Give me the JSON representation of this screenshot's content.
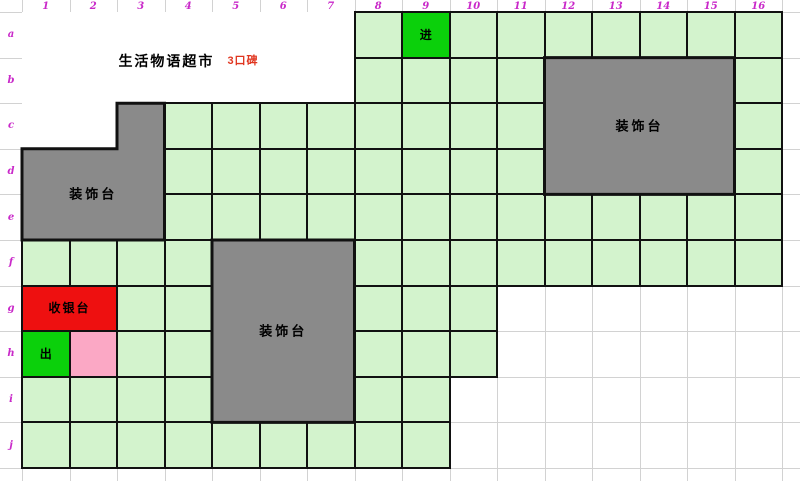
{
  "sheet": {
    "column_headers": [
      "1",
      "2",
      "3",
      "4",
      "5",
      "6",
      "7",
      "8",
      "9",
      "10",
      "11",
      "12",
      "13",
      "14",
      "15",
      "16"
    ],
    "row_headers": [
      "a",
      "b",
      "c",
      "d",
      "e",
      "f",
      "g",
      "h",
      "i",
      "j"
    ]
  },
  "title": {
    "text": "生活物语超市",
    "badge": "3口碑"
  },
  "map": {
    "shelf_cells": [
      {
        "row": "a",
        "ranges": [
          [
            8,
            8
          ],
          [
            10,
            16
          ]
        ]
      },
      {
        "row": "b",
        "ranges": [
          [
            8,
            11
          ],
          [
            16,
            16
          ]
        ]
      },
      {
        "row": "c",
        "ranges": [
          [
            4,
            11
          ],
          [
            16,
            16
          ]
        ]
      },
      {
        "row": "d",
        "ranges": [
          [
            4,
            11
          ],
          [
            16,
            16
          ]
        ]
      },
      {
        "row": "e",
        "ranges": [
          [
            4,
            16
          ]
        ]
      },
      {
        "row": "f",
        "ranges": [
          [
            1,
            4
          ],
          [
            8,
            16
          ]
        ]
      },
      {
        "row": "g",
        "ranges": [
          [
            3,
            4
          ],
          [
            8,
            10
          ]
        ]
      },
      {
        "row": "h",
        "ranges": [
          [
            3,
            4
          ],
          [
            8,
            10
          ]
        ]
      },
      {
        "row": "i",
        "ranges": [
          [
            1,
            4
          ],
          [
            8,
            9
          ]
        ]
      },
      {
        "row": "j",
        "ranges": [
          [
            1,
            9
          ]
        ]
      }
    ],
    "entrance": {
      "row": "a",
      "col": 9,
      "label": "进"
    },
    "exit": {
      "row": "h",
      "col": 1,
      "label": "出"
    },
    "pink_cell": {
      "row": "h",
      "col": 2
    },
    "cashier": {
      "row": "g",
      "cols": [
        1,
        2
      ],
      "label": "收银台"
    },
    "decoration_blocks": [
      {
        "position": "left",
        "label": "装饰台",
        "parts": [
          {
            "rows": [
              "c",
              "c"
            ],
            "cols": [
              3,
              3
            ]
          },
          {
            "rows": [
              "d",
              "e"
            ],
            "cols": [
              1,
              3
            ]
          }
        ],
        "label_part": 1
      },
      {
        "position": "right",
        "label": "装饰台",
        "parts": [
          {
            "rows": [
              "b",
              "d"
            ],
            "cols": [
              12,
              15
            ]
          }
        ],
        "label_part": 0
      },
      {
        "position": "middle",
        "label": "装饰台",
        "parts": [
          {
            "rows": [
              "f",
              "i"
            ],
            "cols": [
              5,
              7
            ]
          }
        ],
        "label_part": 0
      }
    ]
  },
  "colors": {
    "shelf_green": "#d3f3cd",
    "bright_green": "#0bd00b",
    "decoration_gray": "#8a8a8a",
    "cashier_red": "#ee1010",
    "pink": "#fba8c5",
    "header_magenta": "#c929c9",
    "badge_red": "#e0351f",
    "gridline_gray": "#d2d2d2",
    "border_black": "#111111"
  }
}
